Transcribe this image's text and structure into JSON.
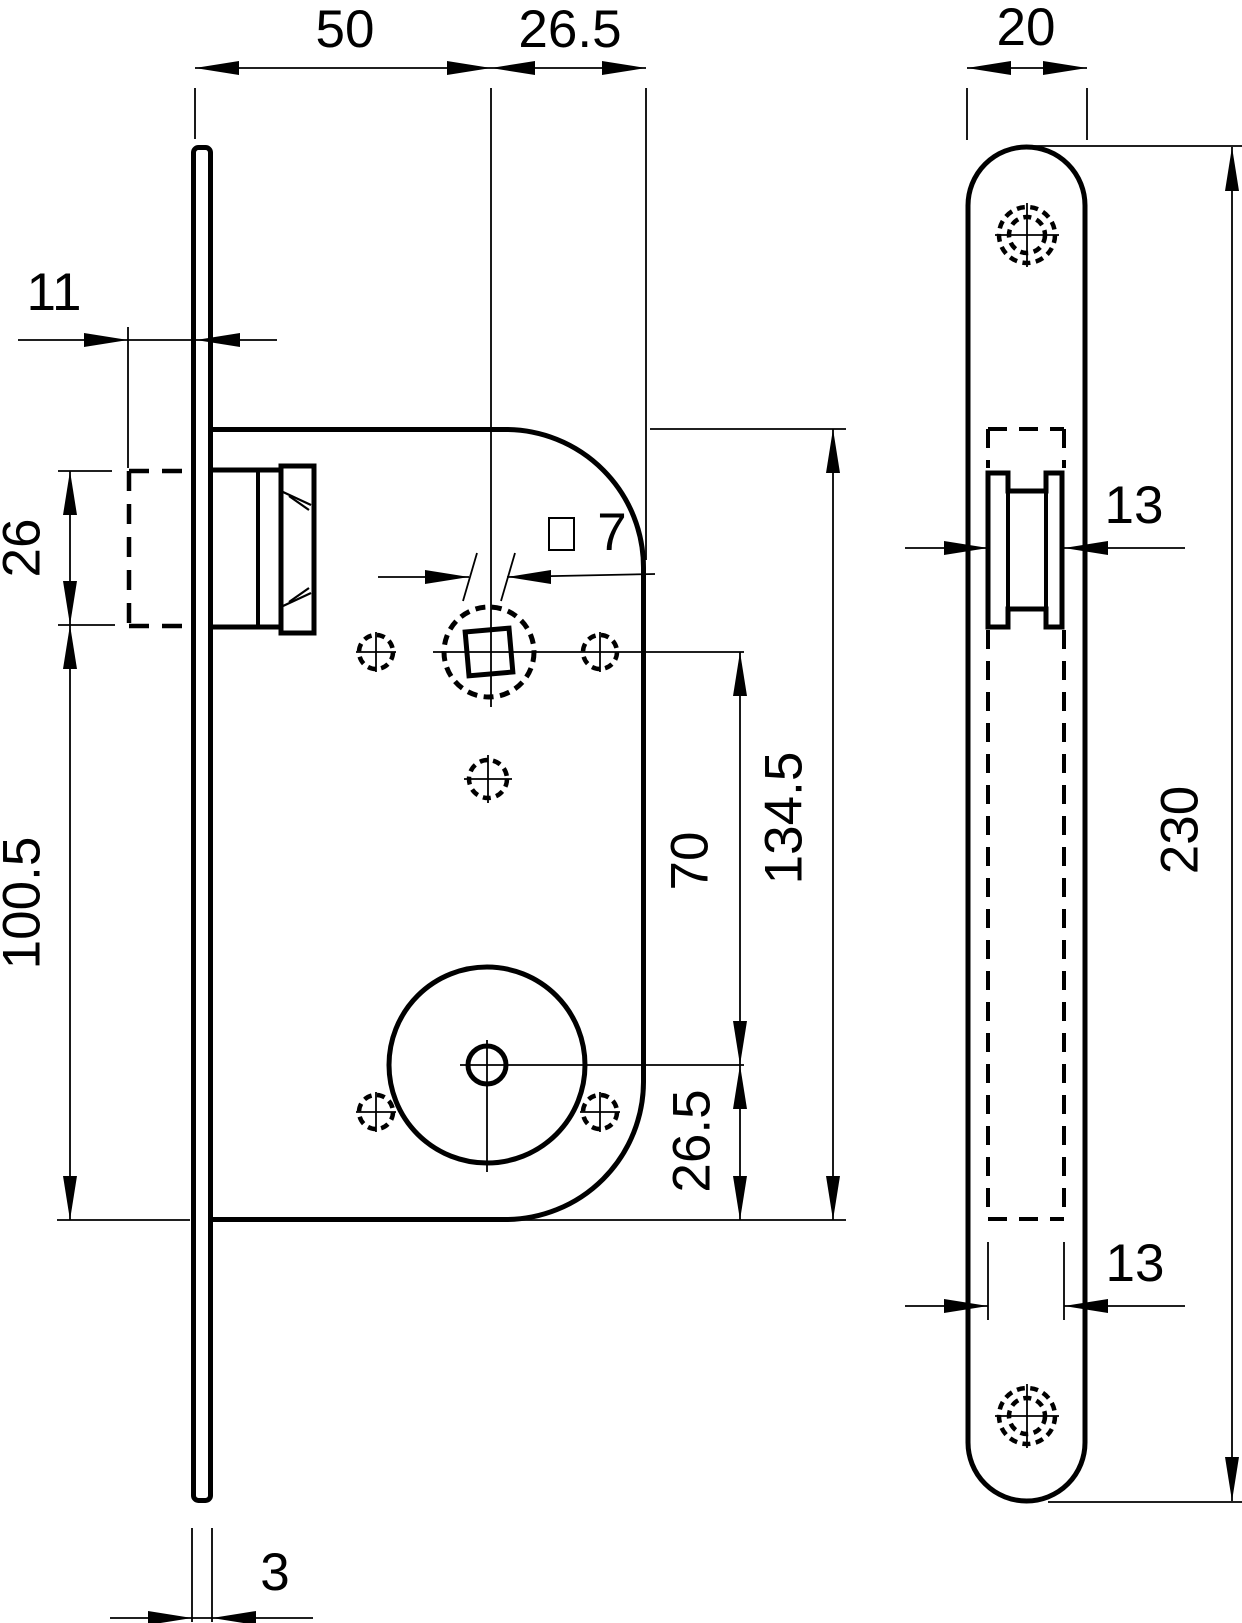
{
  "page": {
    "background_color": "#ffffff",
    "ink_color": "#000000",
    "description_labels": {}
  },
  "dimensions": {
    "backset": "50",
    "follower_to_case_edge": "26.5",
    "faceplate_width": "20",
    "latch_protrusion": "11",
    "latch_height": "26",
    "latch_to_case_bottom": "100.5",
    "spindle_square": "7",
    "follower_to_cylinder": "70",
    "case_length": "134.5",
    "cylinder_to_case_bottom": "26.5",
    "case_width_at_latch": "13",
    "case_width_lower": "13",
    "faceplate_length": "230",
    "faceplate_thickness": "3"
  }
}
